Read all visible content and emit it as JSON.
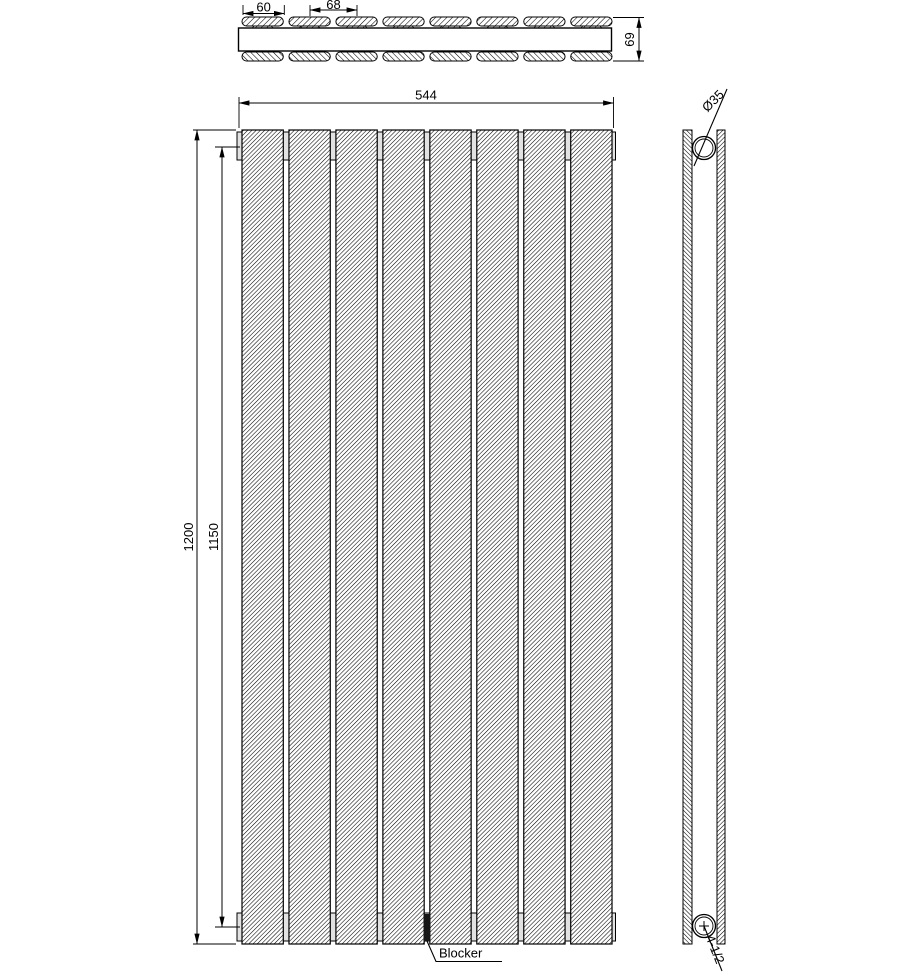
{
  "drawing": {
    "panel_count": 8,
    "dimensions": {
      "overall_width": "544",
      "panel_width": "60",
      "panel_pitch": "68",
      "depth": "69",
      "overall_height": "1200",
      "connection_spacing": "1150",
      "tube_diameter": "Ø35",
      "connection_thread": "4-1/2"
    },
    "labels": {
      "blocker": "Blocker"
    },
    "colors": {
      "line": "#000000",
      "background": "#ffffff",
      "header_tube_fill": "#e2e2e2",
      "blocker_fill": "#161616"
    }
  }
}
